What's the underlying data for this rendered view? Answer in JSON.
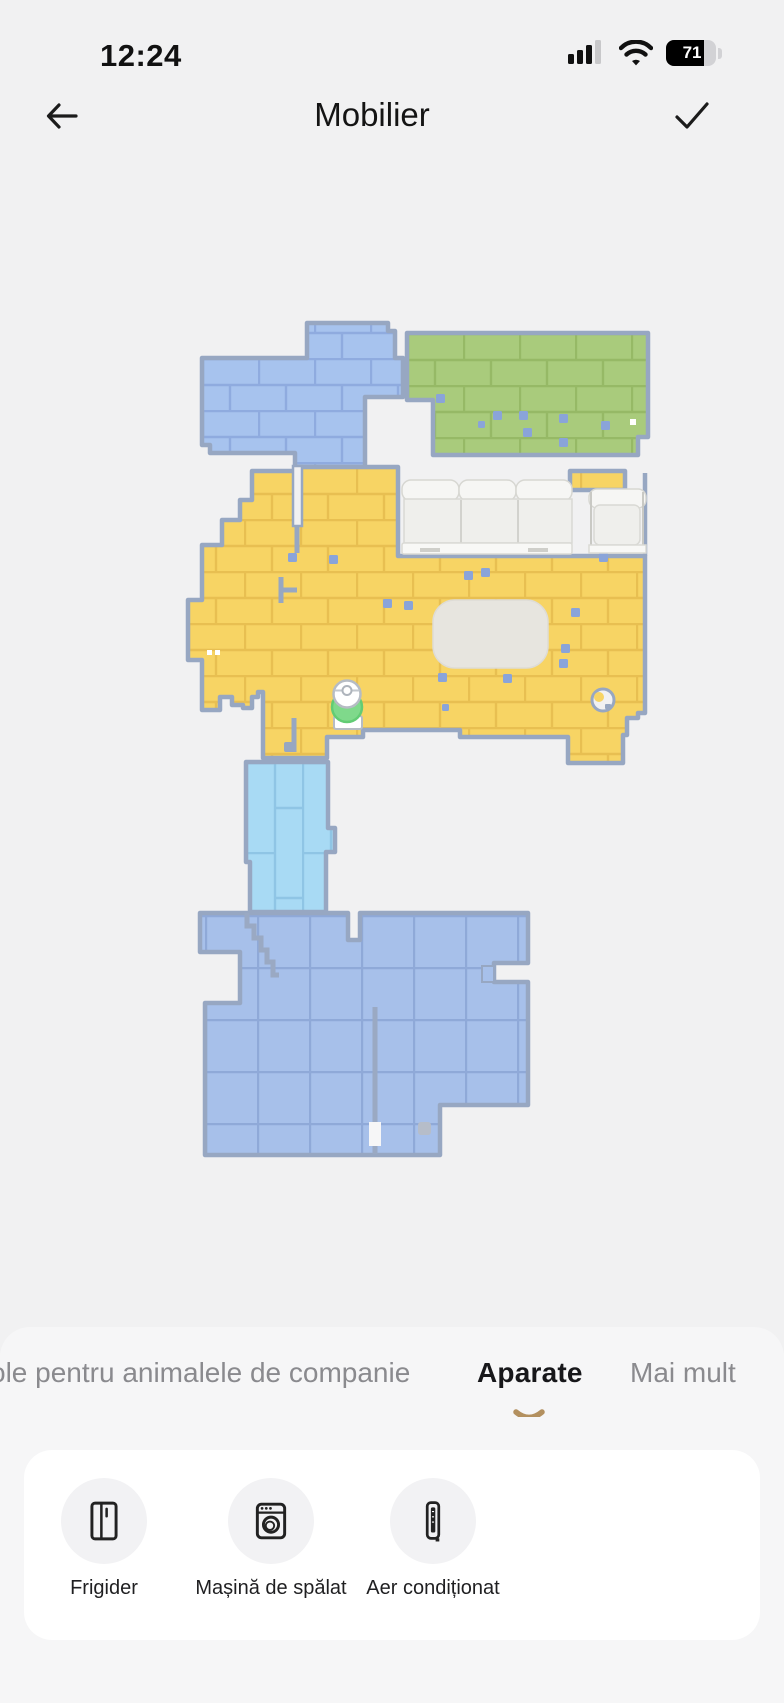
{
  "status_bar": {
    "time": "12:24",
    "battery_percent": "71",
    "signal_bars_filled": 3,
    "signal_bars_total": 4
  },
  "header": {
    "title": "Mobilier"
  },
  "map": {
    "rooms": [
      {
        "id": "room-top-left",
        "color": "#a7c3ee",
        "pattern": "brick"
      },
      {
        "id": "room-top-right",
        "color": "#a9cb7c",
        "pattern": "brick"
      },
      {
        "id": "room-living",
        "color": "#f7d464",
        "pattern": "brick"
      },
      {
        "id": "room-corridor",
        "color": "#a8daf4",
        "pattern": "plank"
      },
      {
        "id": "room-bottom",
        "color": "#a7c0ea",
        "pattern": "tile"
      }
    ],
    "wall_color": "#97a7c2",
    "furniture": [
      {
        "id": "sofa"
      },
      {
        "id": "armchair"
      },
      {
        "id": "rug"
      }
    ],
    "robot": {
      "id": "robot-vacuum",
      "dock_color": "#7fd98b"
    }
  },
  "tabs": {
    "items": [
      {
        "label": "ole pentru animalele de companie",
        "active": false
      },
      {
        "label": "Aparate",
        "active": true
      },
      {
        "label": "Mai mult",
        "active": false
      }
    ],
    "indicator_color": "#b3905f"
  },
  "appliances": {
    "items": [
      {
        "label": "Frigider",
        "icon": "fridge-icon"
      },
      {
        "label": "Mașină de spălat",
        "icon": "washing-machine-icon"
      },
      {
        "label": "Aer condiționat",
        "icon": "air-conditioner-icon"
      }
    ]
  }
}
